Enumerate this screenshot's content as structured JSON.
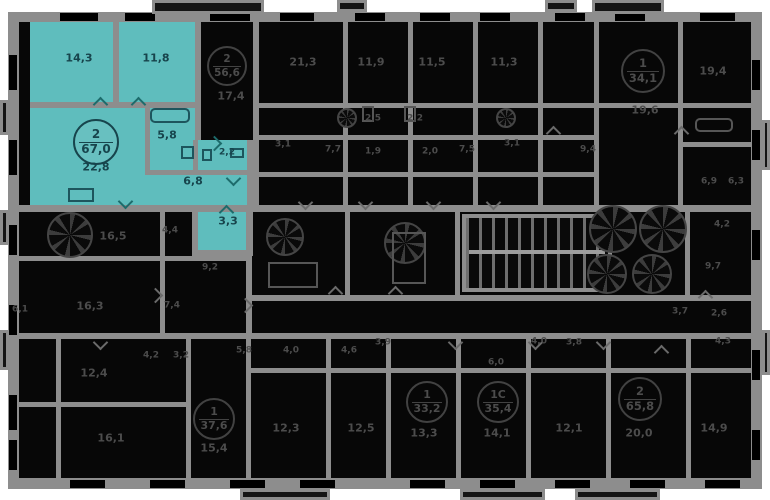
{
  "meta": {
    "view": "residential-floor-plan",
    "background": "#ffffff",
    "wall_color": "#8d8d8d",
    "room_fill": "#070707",
    "highlight_color": "#5fbdbd"
  },
  "floorplan": {
    "highlighted_apartment": {
      "badge": {
        "top": "2",
        "bottom": "67,0",
        "x": 96,
        "y": 142,
        "r": 23,
        "theme": "hl"
      },
      "total_area": "67,0",
      "rooms_count": "2",
      "room_areas": [
        "14,3",
        "11,8",
        "22,8",
        "5,8",
        "2,2",
        "6,8",
        "3,3"
      ]
    },
    "labels": [
      {
        "text": "14,3",
        "x": 79,
        "y": 58,
        "theme": "hl",
        "size": "md"
      },
      {
        "text": "11,8",
        "x": 156,
        "y": 58,
        "theme": "hl",
        "size": "md"
      },
      {
        "text": "22,8",
        "x": 96,
        "y": 167,
        "theme": "hl",
        "size": "md"
      },
      {
        "text": "5,8",
        "x": 167,
        "y": 135,
        "theme": "hl",
        "size": "md"
      },
      {
        "text": "2,2",
        "x": 227,
        "y": 153,
        "theme": "hl",
        "size": "sm"
      },
      {
        "text": "6,8",
        "x": 193,
        "y": 181,
        "theme": "hl",
        "size": "md"
      },
      {
        "text": "3,3",
        "x": 228,
        "y": 221,
        "theme": "hl",
        "size": "md"
      },
      {
        "text": "17,4",
        "x": 231,
        "y": 96,
        "theme": "dim",
        "size": "md"
      },
      {
        "text": "21,3",
        "x": 303,
        "y": 62,
        "theme": "dim",
        "size": "md"
      },
      {
        "text": "11,9",
        "x": 371,
        "y": 62,
        "theme": "dim",
        "size": "md"
      },
      {
        "text": "11,5",
        "x": 432,
        "y": 62,
        "theme": "dim",
        "size": "md"
      },
      {
        "text": "11,3",
        "x": 504,
        "y": 62,
        "theme": "dim",
        "size": "md"
      },
      {
        "text": "19,4",
        "x": 713,
        "y": 71,
        "theme": "dim",
        "size": "md"
      },
      {
        "text": "19,6",
        "x": 645,
        "y": 110,
        "theme": "dim",
        "size": "md"
      },
      {
        "text": "2,5",
        "x": 373,
        "y": 119,
        "theme": "dim",
        "size": "sm"
      },
      {
        "text": "2,2",
        "x": 415,
        "y": 119,
        "theme": "dim",
        "size": "sm"
      },
      {
        "text": "3,1",
        "x": 283,
        "y": 145,
        "theme": "dim",
        "size": "sm"
      },
      {
        "text": "7,7",
        "x": 333,
        "y": 150,
        "theme": "dim",
        "size": "sm"
      },
      {
        "text": "1,9",
        "x": 373,
        "y": 152,
        "theme": "dim",
        "size": "sm"
      },
      {
        "text": "2,0",
        "x": 430,
        "y": 152,
        "theme": "dim",
        "size": "sm"
      },
      {
        "text": "7,5",
        "x": 467,
        "y": 150,
        "theme": "dim",
        "size": "sm"
      },
      {
        "text": "3,1",
        "x": 512,
        "y": 144,
        "theme": "dim",
        "size": "sm"
      },
      {
        "text": "9,4",
        "x": 588,
        "y": 150,
        "theme": "dim",
        "size": "sm"
      },
      {
        "text": "6,9",
        "x": 709,
        "y": 182,
        "theme": "dim",
        "size": "sm"
      },
      {
        "text": "6,3",
        "x": 736,
        "y": 182,
        "theme": "dim",
        "size": "sm"
      },
      {
        "text": "16,5",
        "x": 113,
        "y": 236,
        "theme": "dim",
        "size": "md"
      },
      {
        "text": "4,4",
        "x": 170,
        "y": 231,
        "theme": "dim",
        "size": "sm"
      },
      {
        "text": "9,2",
        "x": 210,
        "y": 268,
        "theme": "dim",
        "size": "sm"
      },
      {
        "text": "16,3",
        "x": 90,
        "y": 306,
        "theme": "dim",
        "size": "md"
      },
      {
        "text": "7,4",
        "x": 172,
        "y": 306,
        "theme": "dim",
        "size": "sm"
      },
      {
        "text": "6,1",
        "x": 20,
        "y": 310,
        "theme": "dim",
        "size": "sm"
      },
      {
        "text": "4,2",
        "x": 722,
        "y": 225,
        "theme": "dim",
        "size": "sm"
      },
      {
        "text": "9,7",
        "x": 713,
        "y": 267,
        "theme": "dim",
        "size": "sm"
      },
      {
        "text": "3,7",
        "x": 680,
        "y": 312,
        "theme": "dim",
        "size": "sm"
      },
      {
        "text": "2,6",
        "x": 719,
        "y": 314,
        "theme": "dim",
        "size": "sm"
      },
      {
        "text": "4,0",
        "x": 291,
        "y": 351,
        "theme": "dim",
        "size": "sm"
      },
      {
        "text": "4,6",
        "x": 349,
        "y": 351,
        "theme": "dim",
        "size": "sm"
      },
      {
        "text": "3,9",
        "x": 383,
        "y": 343,
        "theme": "dim",
        "size": "sm"
      },
      {
        "text": "5,8",
        "x": 244,
        "y": 351,
        "theme": "dim",
        "size": "sm"
      },
      {
        "text": "4,2",
        "x": 151,
        "y": 356,
        "theme": "dim",
        "size": "sm"
      },
      {
        "text": "3,2",
        "x": 181,
        "y": 356,
        "theme": "dim",
        "size": "sm"
      },
      {
        "text": "4,0",
        "x": 539,
        "y": 342,
        "theme": "dim",
        "size": "sm"
      },
      {
        "text": "3,8",
        "x": 574,
        "y": 343,
        "theme": "dim",
        "size": "sm"
      },
      {
        "text": "4,3",
        "x": 723,
        "y": 342,
        "theme": "dim",
        "size": "sm"
      },
      {
        "text": "6,0",
        "x": 496,
        "y": 363,
        "theme": "dim",
        "size": "sm"
      },
      {
        "text": "12,4",
        "x": 94,
        "y": 373,
        "theme": "dim",
        "size": "md"
      },
      {
        "text": "16,1",
        "x": 111,
        "y": 438,
        "theme": "dim",
        "size": "md"
      },
      {
        "text": "15,4",
        "x": 214,
        "y": 448,
        "theme": "dim",
        "size": "md"
      },
      {
        "text": "12,3",
        "x": 286,
        "y": 428,
        "theme": "dim",
        "size": "md"
      },
      {
        "text": "12,5",
        "x": 361,
        "y": 428,
        "theme": "dim",
        "size": "md"
      },
      {
        "text": "13,3",
        "x": 424,
        "y": 433,
        "theme": "dim",
        "size": "md"
      },
      {
        "text": "14,1",
        "x": 497,
        "y": 433,
        "theme": "dim",
        "size": "md"
      },
      {
        "text": "12,1",
        "x": 569,
        "y": 428,
        "theme": "dim",
        "size": "md"
      },
      {
        "text": "20,0",
        "x": 639,
        "y": 433,
        "theme": "dim",
        "size": "md"
      },
      {
        "text": "14,9",
        "x": 714,
        "y": 428,
        "theme": "dim",
        "size": "md"
      }
    ],
    "badges": [
      {
        "top": "2",
        "bottom": "67,0",
        "x": 96,
        "y": 142,
        "r": 23,
        "theme": "hl"
      },
      {
        "top": "2",
        "bottom": "56,6",
        "x": 227,
        "y": 66,
        "r": 20,
        "theme": "dim"
      },
      {
        "top": "1",
        "bottom": "34,1",
        "x": 643,
        "y": 71,
        "r": 22,
        "theme": "dim"
      },
      {
        "top": "1",
        "bottom": "37,6",
        "x": 214,
        "y": 419,
        "r": 21,
        "theme": "dim"
      },
      {
        "top": "1",
        "bottom": "33,2",
        "x": 427,
        "y": 402,
        "r": 21,
        "theme": "dim"
      },
      {
        "top": "1С",
        "bottom": "35,4",
        "x": 498,
        "y": 402,
        "r": 21,
        "theme": "dim"
      },
      {
        "top": "2",
        "bottom": "65,8",
        "x": 640,
        "y": 399,
        "r": 22,
        "theme": "dim"
      }
    ],
    "fans": [
      {
        "kind": "elevator",
        "x": 613,
        "y": 229,
        "r": 24
      },
      {
        "kind": "elevator",
        "x": 663,
        "y": 229,
        "r": 24
      },
      {
        "kind": "elevator",
        "x": 607,
        "y": 274,
        "r": 20
      },
      {
        "kind": "elevator",
        "x": 652,
        "y": 274,
        "r": 20
      },
      {
        "kind": "vent",
        "x": 70,
        "y": 235,
        "r": 23
      },
      {
        "kind": "vent",
        "x": 285,
        "y": 237,
        "r": 19
      },
      {
        "kind": "vent",
        "x": 405,
        "y": 243,
        "r": 21
      },
      {
        "kind": "vent",
        "x": 347,
        "y": 118,
        "r": 10
      },
      {
        "kind": "vent",
        "x": 506,
        "y": 118,
        "r": 10
      }
    ],
    "icons": [
      {
        "name": "bathtub-icon",
        "x": 150,
        "y": 108,
        "w": 40,
        "h": 15,
        "theme": "hl",
        "round": true
      },
      {
        "name": "washer-icon",
        "x": 181,
        "y": 146,
        "w": 13,
        "h": 13,
        "theme": "hl"
      },
      {
        "name": "toilet-icon",
        "x": 202,
        "y": 149,
        "w": 10,
        "h": 12,
        "theme": "hl"
      },
      {
        "name": "sink-icon",
        "x": 230,
        "y": 148,
        "w": 14,
        "h": 10,
        "theme": "hl"
      },
      {
        "name": "kitchen-counter-icon",
        "x": 68,
        "y": 188,
        "w": 26,
        "h": 14,
        "theme": "hl"
      },
      {
        "name": "bathtub-icon",
        "x": 695,
        "y": 118,
        "w": 38,
        "h": 14,
        "theme": "dim",
        "round": true
      },
      {
        "name": "toilet-icon",
        "x": 362,
        "y": 106,
        "w": 12,
        "h": 16,
        "theme": "dim"
      },
      {
        "name": "toilet-icon",
        "x": 404,
        "y": 106,
        "w": 12,
        "h": 16,
        "theme": "dim"
      },
      {
        "name": "appliance-block-icon",
        "x": 268,
        "y": 262,
        "w": 50,
        "h": 26,
        "theme": "dim"
      },
      {
        "name": "appliance-block-icon",
        "x": 392,
        "y": 232,
        "w": 34,
        "h": 52,
        "theme": "dim"
      }
    ]
  }
}
